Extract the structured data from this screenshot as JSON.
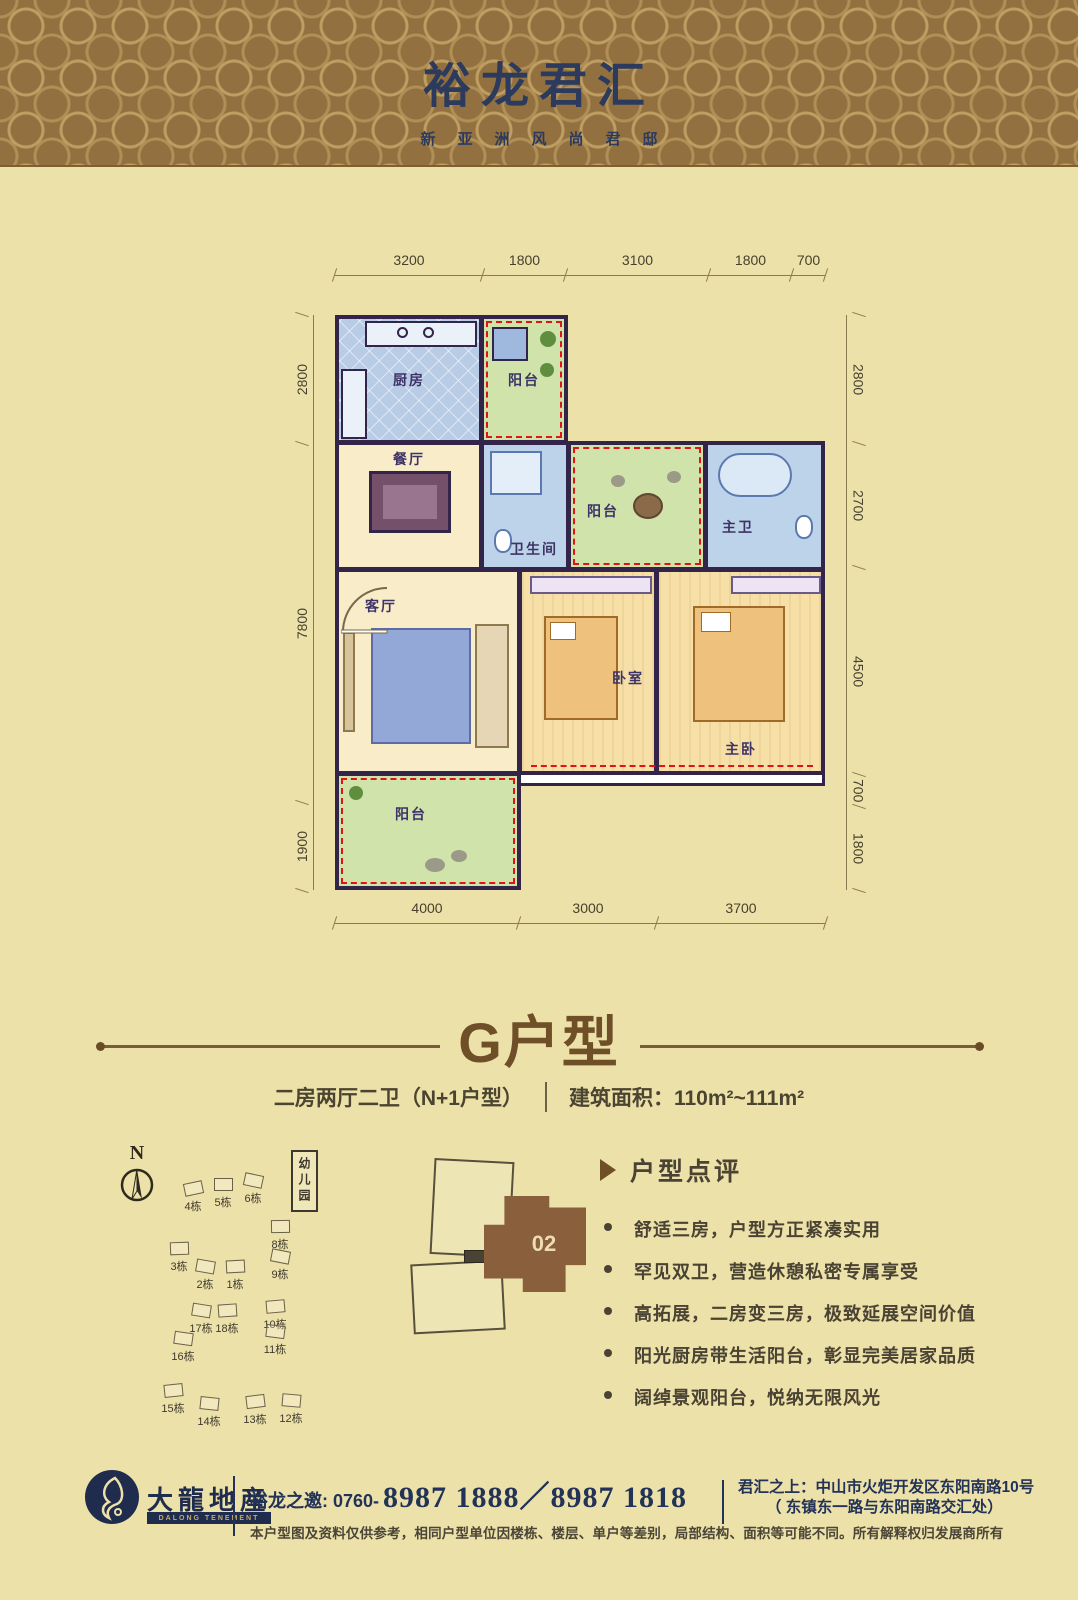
{
  "header": {
    "title": "裕龙君汇",
    "subtitle": "新亚洲风尚君邸"
  },
  "floor_plan": {
    "dims_top": [
      "3200",
      "1800",
      "3100",
      "1800",
      "700"
    ],
    "dims_left": [
      "2800",
      "7800",
      "1900"
    ],
    "dims_right": [
      "2800",
      "2700",
      "4500",
      "700",
      "1800"
    ],
    "dims_bottom": [
      "4000",
      "3000",
      "3700"
    ],
    "rooms": {
      "kitchen": "厨房",
      "balcony_north": "阳台",
      "dining": "餐厅",
      "bath": "卫生间",
      "balcony_center": "阳台",
      "master_bath": "主卫",
      "living": "客厅",
      "bedroom": "卧室",
      "master_bedroom": "主卧",
      "balcony_south": "阳台"
    }
  },
  "unit": {
    "title": "G户型",
    "spec": "二房两厅二卫（N+1户型）",
    "area": "建筑面积：110m²~111m²"
  },
  "site_plan": {
    "compass_label": "N",
    "kindergarten": "幼儿园",
    "key_unit_label": "02",
    "buildings": [
      {
        "label": "4栋",
        "x": 78,
        "y": 42
      },
      {
        "label": "5栋",
        "x": 108,
        "y": 38
      },
      {
        "label": "6栋",
        "x": 138,
        "y": 34
      },
      {
        "label": "8栋",
        "x": 165,
        "y": 80
      },
      {
        "label": "9栋",
        "x": 165,
        "y": 110
      },
      {
        "label": "3栋",
        "x": 64,
        "y": 102
      },
      {
        "label": "2栋",
        "x": 90,
        "y": 120
      },
      {
        "label": "1栋",
        "x": 120,
        "y": 120
      },
      {
        "label": "17栋",
        "x": 86,
        "y": 164
      },
      {
        "label": "18栋",
        "x": 112,
        "y": 164
      },
      {
        "label": "16栋",
        "x": 68,
        "y": 192
      },
      {
        "label": "10栋",
        "x": 160,
        "y": 160
      },
      {
        "label": "11栋",
        "x": 160,
        "y": 185
      },
      {
        "label": "15栋",
        "x": 58,
        "y": 244
      },
      {
        "label": "14栋",
        "x": 94,
        "y": 257
      },
      {
        "label": "13栋",
        "x": 140,
        "y": 255
      },
      {
        "label": "12栋",
        "x": 176,
        "y": 254
      }
    ]
  },
  "review": {
    "title": "户型点评",
    "bullets": [
      "舒适三房，户型方正紧凑实用",
      "罕见双卫，营造休憩私密专属享受",
      "高拓展，二房变三房，极致延展空间价值",
      "阳光厨房带生活阳台，彰显完美居家品质",
      "阔绰景观阳台，悦纳无限风光"
    ]
  },
  "footer": {
    "logo_cn": "大龍地産",
    "logo_en": "DALONG TENEMENT",
    "invite_label": "裕龙之邀: 0760-",
    "phone_numbers": "8987 1888／8987 1818",
    "address_label": "君汇之上：",
    "address_line1": "中山市火炬开发区东阳南路10号",
    "address_line2": "（ 东镇东一路与东阳南路交汇处）",
    "disclaimer": "本户型图及资料仅供参考，相同户型单位因楼栋、楼层、单户等差别，局部结构、面积等可能不同。所有解释权归发展商所有"
  },
  "colors": {
    "page_bg": "#ece1a8",
    "header_bg": "#92703f",
    "header_pattern": "#c9aa6b",
    "navy": "#223258",
    "title_brown": "#6f4f28",
    "wall": "#33254a",
    "balcony_green": "#cfe3ab",
    "bath_blue": "#bdd3e9",
    "red_dash": "#e01414",
    "unit_brown": "#8a5f3c"
  }
}
